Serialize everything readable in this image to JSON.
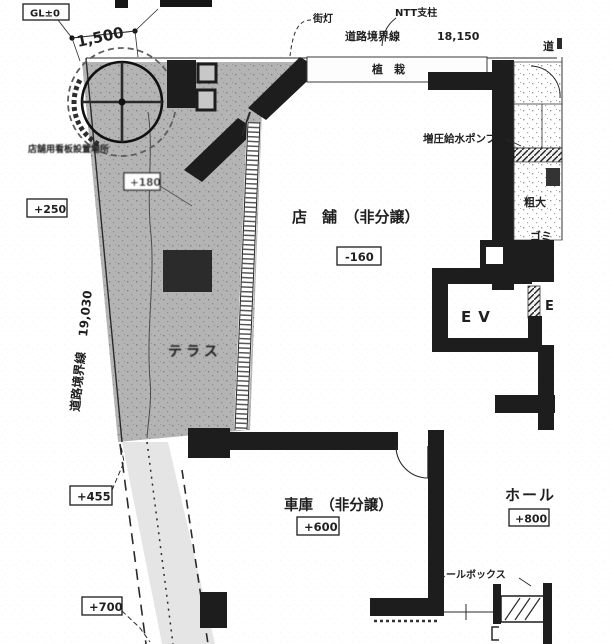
{
  "boundaries": {
    "top": {
      "label": "道路境界線",
      "length": "18,150"
    },
    "left": {
      "label": "道路境界線",
      "length": "19,030"
    },
    "right_partial": "道"
  },
  "site": {
    "gl_level": "GL±0",
    "front_width": "1,500",
    "streetlight": "街灯",
    "ntt_pole": "NTT支柱",
    "planting": "植　栽",
    "sign_area": "店舗用看板設置場所",
    "terrace": "テラス",
    "pump": "増圧給水ポンプ",
    "mailbox": "メールボックス",
    "bulky_waste_line1": "粗大",
    "bulky_waste_line2": "ゴミ"
  },
  "rooms": {
    "shop": {
      "label": "店　舗　（非分譲）",
      "level": "-160"
    },
    "garage": {
      "label": "車庫　（非分譲）",
      "level": "+600"
    },
    "hall": {
      "label": "ホール",
      "level": "+800"
    },
    "elevator": {
      "label": "EV"
    },
    "elevator2": {
      "label": "E"
    }
  },
  "spot_levels": {
    "a": "+180",
    "b": "+250",
    "c": "+455",
    "d": "+700"
  }
}
